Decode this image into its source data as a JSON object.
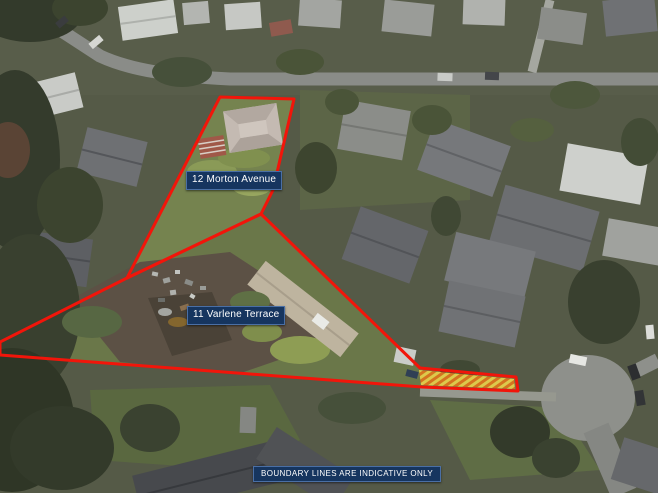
{
  "map": {
    "disclaimer": "BOUNDARY LINES ARE INDICATIVE ONLY",
    "parcels": [
      {
        "id": "morton",
        "label": "12 Morton Avenue",
        "points": "220,97 294,99 273,190 261,214 127,278"
      },
      {
        "id": "varlene",
        "label": "11 Varlene Terrace",
        "points": "261,214 420,368 516,377 518,391 422,387 0,355 0,342 127,278"
      }
    ],
    "easement_hatch": {
      "points": "419,370 514,379 515,389 421,385",
      "fill": "#ddc94b",
      "stripe": "#d4731f"
    },
    "colors": {
      "boundary": "#f2150a",
      "label_bg": "#16355f",
      "label_border": "#4a6fa5",
      "label_text": "#ffffff"
    }
  }
}
